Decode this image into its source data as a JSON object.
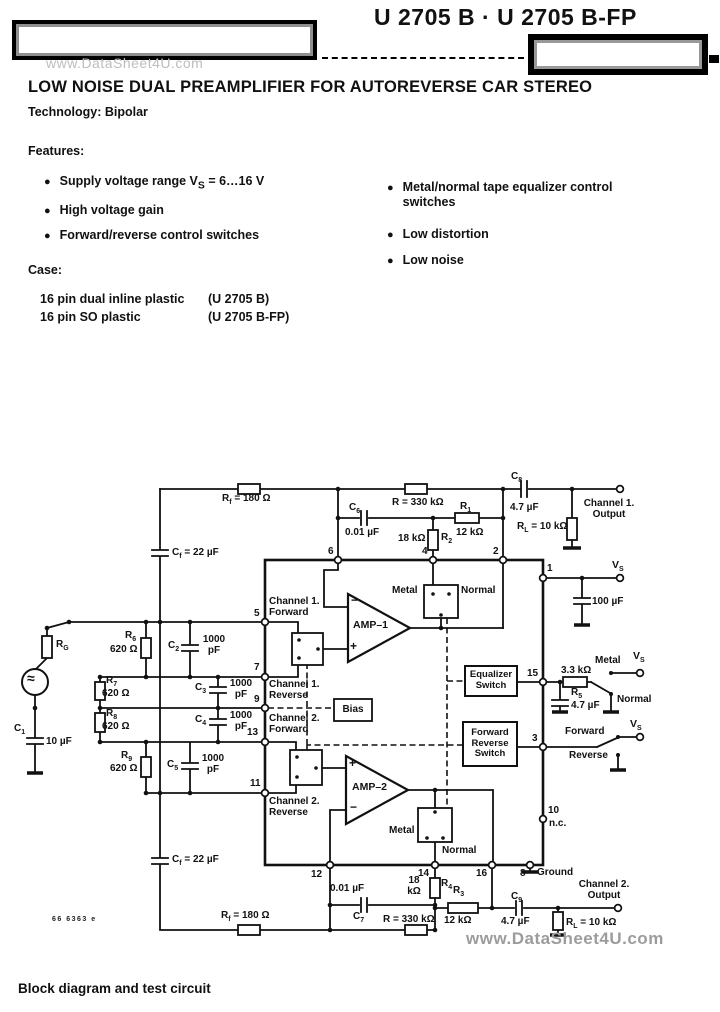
{
  "page": {
    "title": "U 2705 B · U 2705 B-FP",
    "watermark_top": "www.DataSheet4U.com",
    "watermark_bottom": "www.DataSheet4U.com",
    "heading": "LOW NOISE DUAL PREAMPLIFIER FOR AUTOREVERSE CAR STEREO",
    "technology": "Technology: Bipolar",
    "caption": "Block diagram and test circuit",
    "doc_number": "66 6363 e"
  },
  "features": {
    "label": "Features:",
    "left": [
      {
        "parts": [
          {
            "t": "Supply voltage range "
          },
          {
            "t": "V"
          },
          {
            "t": "S",
            "s": 1
          },
          {
            "t": " = 6…16 V"
          }
        ]
      },
      {
        "parts": [
          {
            "t": "High voltage gain"
          }
        ]
      },
      {
        "parts": [
          {
            "t": "Forward/reverse control switches"
          }
        ]
      }
    ],
    "right": [
      {
        "parts": [
          {
            "t": "Metal/normal tape equalizer control switches"
          }
        ]
      },
      {
        "parts": [
          {
            "t": "Low distortion"
          }
        ]
      },
      {
        "parts": [
          {
            "t": "Low noise"
          }
        ]
      }
    ]
  },
  "case_info": {
    "label": "Case:",
    "items": [
      {
        "text": "16 pin dual inline plastic",
        "variant": "(U 2705 B)"
      },
      {
        "text": "16 pin SO plastic",
        "variant": "(U 2705 B-FP)"
      }
    ]
  },
  "schematic": {
    "labels": {
      "rf_top": [
        {
          "t": "R"
        },
        {
          "t": "f",
          "s": 1
        },
        {
          "t": " = 180 Ω"
        }
      ],
      "rf_bot": [
        {
          "t": "R"
        },
        {
          "t": "f",
          "s": 1
        },
        {
          "t": " = 180 Ω"
        }
      ],
      "cf_top": [
        {
          "t": "C"
        },
        {
          "t": "f",
          "s": 1
        },
        {
          "t": " = 22 µF"
        }
      ],
      "cf_bot": [
        {
          "t": "C"
        },
        {
          "t": "f",
          "s": 1
        },
        {
          "t": " = 22 µF"
        }
      ],
      "r330_top": "R = 330 kΩ",
      "r330_bot": "R = 330 kΩ",
      "c6": [
        {
          "t": "C"
        },
        {
          "t": "6",
          "s": 1
        }
      ],
      "c6_val": "0.01 µF",
      "c7": [
        {
          "t": "C"
        },
        {
          "t": "7",
          "s": 1
        }
      ],
      "c7_val": "0.01 µF",
      "c8": [
        {
          "t": "C"
        },
        {
          "t": "8",
          "s": 1
        }
      ],
      "c8_val": "4.7 µF",
      "c9": [
        {
          "t": "C"
        },
        {
          "t": "9",
          "s": 1
        }
      ],
      "c9_val": "4.7 µF",
      "r1": [
        {
          "t": "R"
        },
        {
          "t": "1",
          "s": 1
        }
      ],
      "r1_val": "12 kΩ",
      "r2": [
        {
          "t": "R"
        },
        {
          "t": "2",
          "s": 1
        }
      ],
      "r2_val": "18 kΩ",
      "r3": [
        {
          "t": "R"
        },
        {
          "t": "3",
          "s": 1
        }
      ],
      "r3_val": "12 kΩ",
      "r4": [
        {
          "t": "R"
        },
        {
          "t": "4",
          "s": 1
        }
      ],
      "r4_val": "18 kΩ",
      "r5": [
        {
          "t": "R"
        },
        {
          "t": "5",
          "s": 1
        }
      ],
      "r5_val": "3.3 kΩ",
      "c15_val": "4.7 µF",
      "rl1": [
        {
          "t": "R"
        },
        {
          "t": "L",
          "s": 1
        },
        {
          "t": " = 10 kΩ"
        }
      ],
      "rl2": [
        {
          "t": "R"
        },
        {
          "t": "L",
          "s": 1
        },
        {
          "t": " = 10 kΩ"
        }
      ],
      "vs1": [
        {
          "t": "V"
        },
        {
          "t": "S",
          "s": 1
        }
      ],
      "vs_eq": [
        {
          "t": "V"
        },
        {
          "t": "S",
          "s": 1
        }
      ],
      "vs_fr": [
        {
          "t": "V"
        },
        {
          "t": "S",
          "s": 1
        }
      ],
      "c_vs_val": "100 µF",
      "rg": [
        {
          "t": "R"
        },
        {
          "t": "G",
          "s": 1
        }
      ],
      "gen": "≈",
      "c1": [
        {
          "t": "C"
        },
        {
          "t": "1",
          "s": 1
        }
      ],
      "c1_val": "10 µF",
      "r6": [
        {
          "t": "R"
        },
        {
          "t": "6",
          "s": 1
        }
      ],
      "r6_val": "620 Ω",
      "r7": [
        {
          "t": "R"
        },
        {
          "t": "7",
          "s": 1
        }
      ],
      "r7_val": "620 Ω",
      "r8": [
        {
          "t": "R"
        },
        {
          "t": "8",
          "s": 1
        }
      ],
      "r8_val": "620 Ω",
      "r9": [
        {
          "t": "R"
        },
        {
          "t": "9",
          "s": 1
        }
      ],
      "r9_val": "620 Ω",
      "c2": [
        {
          "t": "C"
        },
        {
          "t": "2",
          "s": 1
        }
      ],
      "c2_val": "1000 pF",
      "c3": [
        {
          "t": "C"
        },
        {
          "t": "3",
          "s": 1
        }
      ],
      "c3_val": "1000 pF",
      "c4": [
        {
          "t": "C"
        },
        {
          "t": "4",
          "s": 1
        }
      ],
      "c4_val": "1000 pF",
      "c5": [
        {
          "t": "C"
        },
        {
          "t": "5",
          "s": 1
        }
      ],
      "c5_val": "1000 pF",
      "amp1": "AMP–1",
      "amp2": "AMP–2",
      "amp1_minus": "−",
      "amp1_plus": "+",
      "amp2_plus": "+",
      "amp2_minus": "−",
      "bias": "Bias",
      "eq_switch": "Equalizer Switch",
      "fr_switch": "Forward Reverse Switch",
      "metal1": "Metal",
      "normal1": "Normal",
      "metal2": "Metal",
      "normal2": "Normal",
      "metal_eq": "Metal",
      "normal_eq": "Normal",
      "forward": "Forward",
      "reverse": "Reverse",
      "ch1_fwd": "Channel 1. Forward",
      "ch1_rev": "Channel 1. Reverse",
      "ch2_fwd": "Channel 2. Forward",
      "ch2_rev": "Channel 2. Reverse",
      "ch1_out": "Channel 1. Output",
      "ch2_out": "Channel 2. Output",
      "ground": "Ground",
      "pin1": "1",
      "pin2": "2",
      "pin3": "3",
      "pin4": "4",
      "pin5": "5",
      "pin6": "6",
      "pin7": "7",
      "pin8": "8",
      "pin9": "9",
      "pin10": "10",
      "pin10_nc": "n.c.",
      "pin11": "11",
      "pin12": "12",
      "pin13": "13",
      "pin14": "14",
      "pin15": "15",
      "pin16": "16"
    }
  }
}
